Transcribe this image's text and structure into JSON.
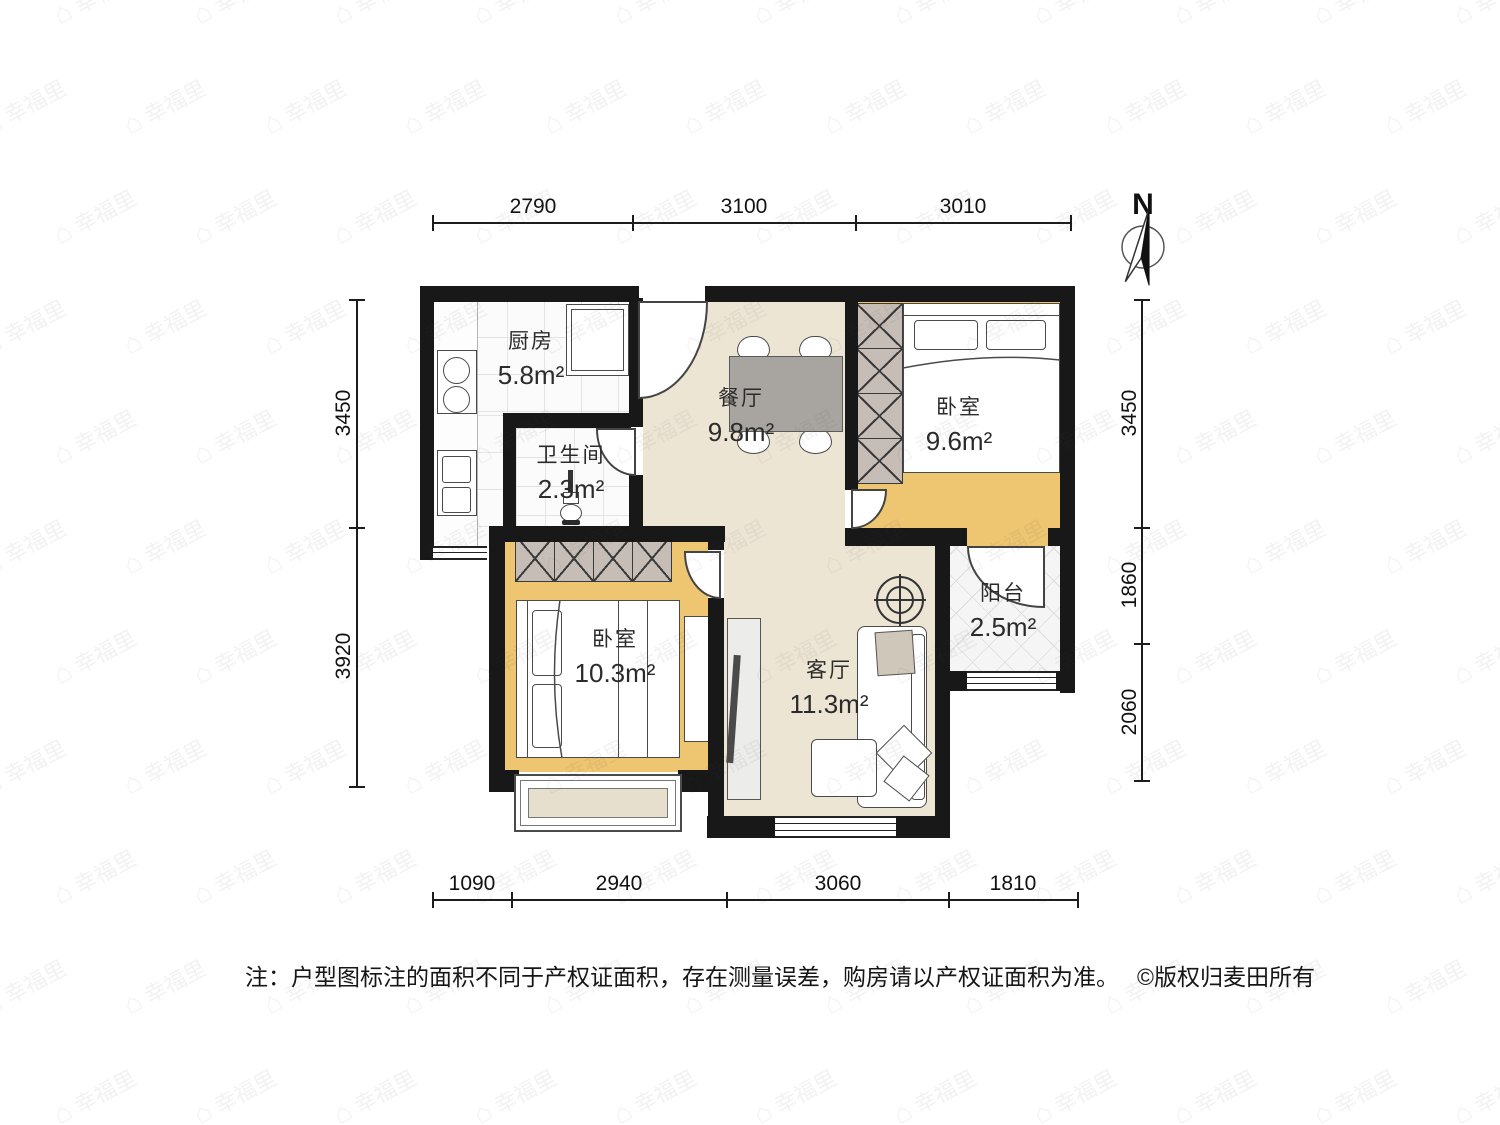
{
  "watermark": {
    "text": "幸福里",
    "icon": "⌂"
  },
  "compass": {
    "label": "N"
  },
  "rooms": {
    "kitchen": {
      "name": "厨房",
      "area": "5.8m²"
    },
    "dining": {
      "name": "餐厅",
      "area": "9.8m²"
    },
    "bedroom_top": {
      "name": "卧室",
      "area": "9.6m²"
    },
    "bathroom": {
      "name": "卫生间",
      "area": "2.3m²"
    },
    "bedroom_left": {
      "name": "卧室",
      "area": "10.3m²"
    },
    "living": {
      "name": "客厅",
      "area": "11.3m²"
    },
    "balcony": {
      "name": "阳台",
      "area": "2.5m²"
    }
  },
  "dimensions": {
    "top": [
      "2790",
      "3100",
      "3010"
    ],
    "bottom": [
      "1090",
      "2940",
      "3060",
      "1810"
    ],
    "left": [
      "3450",
      "3920"
    ],
    "right": [
      "3450",
      "1860",
      "2060"
    ]
  },
  "note": "注：户型图标注的面积不同于产权证面积，存在测量误差，购房请以产权证面积为准。",
  "copyright": "©版权归麦田所有",
  "colors": {
    "wall": "#181818",
    "floor_beige": "#ede5d4",
    "floor_wood": "#eec571",
    "wardrobe": "#c6beb6",
    "table": "#a8a5a0"
  }
}
